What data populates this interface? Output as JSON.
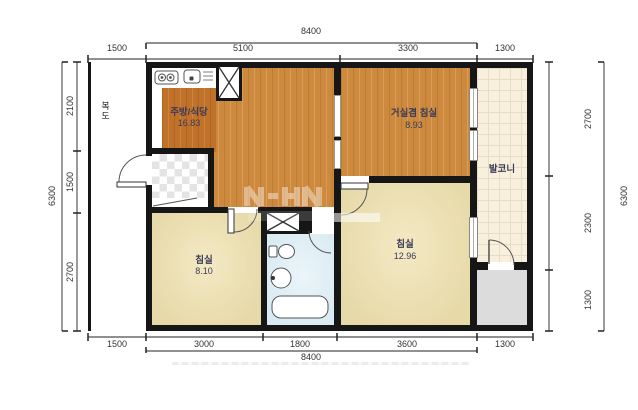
{
  "rooms": {
    "corridor": {
      "label": "복도"
    },
    "kitchen": {
      "label": "주방/식당",
      "area": "16.83"
    },
    "living": {
      "label": "거실겸 침실",
      "area": "8.93"
    },
    "balcony": {
      "label": "발코니"
    },
    "bedroom1": {
      "label": "침실",
      "area": "8.10"
    },
    "bedroom2": {
      "label": "침실",
      "area": "12.96"
    }
  },
  "dimensions": {
    "top": {
      "total": "8400",
      "segments": [
        "1500",
        "5100",
        "3300",
        "1300"
      ]
    },
    "bottom": {
      "total": "8400",
      "segments": [
        "1500",
        "3000",
        "1800",
        "3600",
        "1300"
      ]
    },
    "left": {
      "total": "6300",
      "segments": [
        "2100",
        "1500",
        "2700"
      ]
    },
    "right": {
      "total": "6300",
      "segments": [
        "2700",
        "2300",
        "1300"
      ]
    }
  },
  "icons": {
    "stove": "stove-burners",
    "sink": "kitchen-sink",
    "shaft": "duct-shaft-x",
    "toilet": "toilet",
    "washbasin": "washbasin",
    "bathtub": "bathtub",
    "door": "door-swing-arc"
  },
  "colors": {
    "wall": "#161616",
    "wood_floor": "#cd8a3f",
    "kitchen_floor": "#c1722a",
    "bedroom_floor": "#ebdfb2",
    "bathroom_floor": "#ddeef4",
    "balcony_floor": "#f8f0dd",
    "utility_floor": "#dcdcdc",
    "label_text": "#3b3b56"
  }
}
